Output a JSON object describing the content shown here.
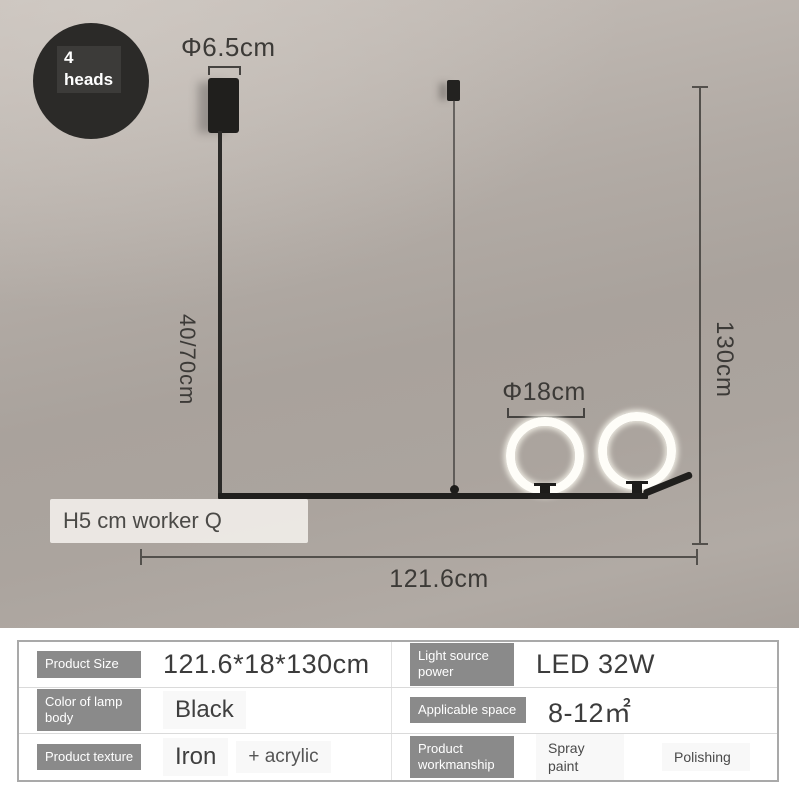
{
  "badge": {
    "line1": "4",
    "line2": "heads"
  },
  "dimensions": {
    "canopy_diameter": "Φ6.5cm",
    "rod_length": "40/70cm",
    "total_height": "130cm",
    "ring_diameter": "Φ18cm",
    "fixture_length": "121.6cm"
  },
  "watermark": "H5 cm worker Q",
  "colors": {
    "wall": "#b1aaa4",
    "fixture_black": "#201f1d",
    "ring_glow": "#fefdf8",
    "label_chip_bg": "#8a8a8a",
    "dimension_line": "#53504c"
  },
  "spec_table": {
    "rows": [
      {
        "cells": [
          {
            "label": "Product Size",
            "value": "121.6*18*130cm"
          },
          {
            "label": "Light source power",
            "value": "LED 32W"
          }
        ]
      },
      {
        "cells": [
          {
            "label": "Color of lamp body",
            "value": "Black"
          },
          {
            "label": "Applicable space",
            "value": "8-12㎡"
          }
        ]
      },
      {
        "cells": [
          {
            "label": "Product texture",
            "value": "Iron",
            "value2": "+ acrylic"
          },
          {
            "label": "Product workmanship",
            "value": "Spray paint",
            "value2": "Polishing"
          }
        ]
      }
    ]
  }
}
